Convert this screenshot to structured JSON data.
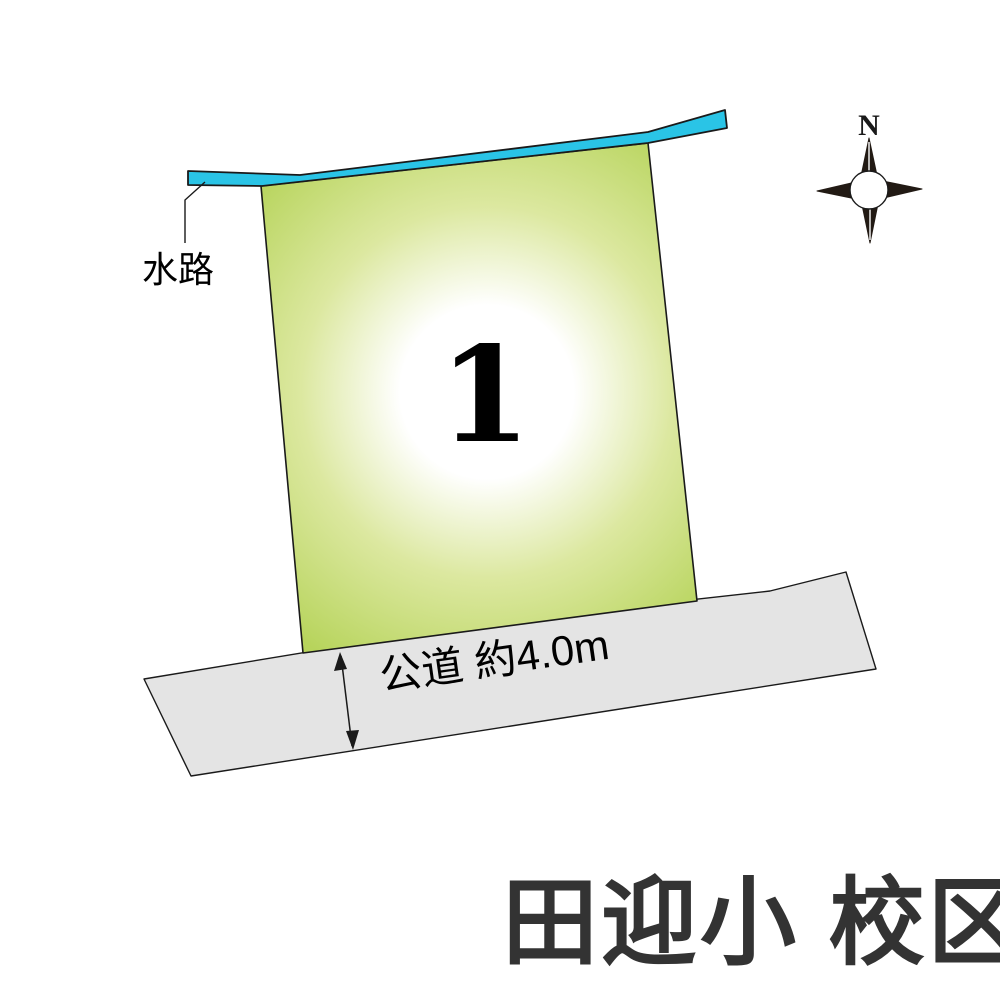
{
  "diagram": {
    "lot_number": "1",
    "waterway_label": "水路",
    "road_label": "公道 約4.0m",
    "school_district_label": "田迎小 校区",
    "compass_north_label": "N"
  },
  "colors": {
    "waterway": "#2ac4e6",
    "plot_center": "#ffffff",
    "plot_mid": "#dce8a0",
    "plot_edge": "#b7d45c",
    "road": "#e4e4e4",
    "outline": "#1a1a1a",
    "compass": "#221a14",
    "compass_circle": "#ffffff",
    "school_text": "#333333"
  }
}
